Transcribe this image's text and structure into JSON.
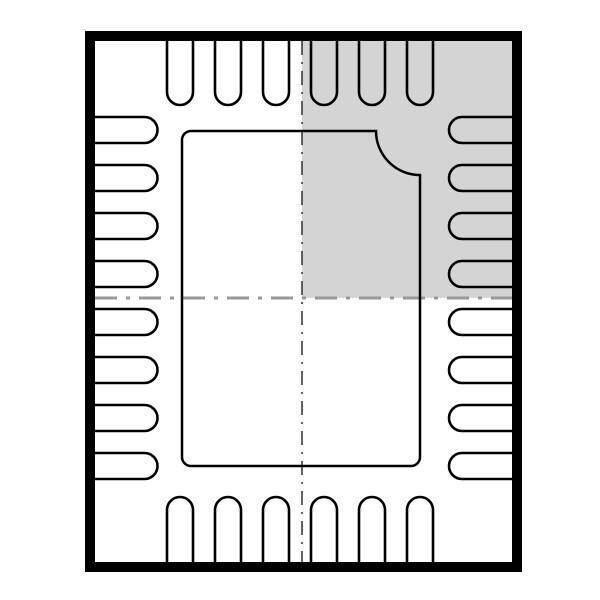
{
  "diagram": {
    "package_type": "QFN-28",
    "description": "ic-package-outline-top-view",
    "total_pins": 28,
    "colors": {
      "line": "#000000",
      "background": "#ffffff",
      "highlight_fill": "#d4d4d4",
      "centerline_horizontal": "#999999",
      "centerline_vertical": "#3d3d3d"
    },
    "outline": {
      "x": 90,
      "y": 36,
      "width": 427,
      "height": 531,
      "stroke_width": 10
    },
    "inner": {
      "left": 95,
      "top": 41,
      "right": 512,
      "bottom": 562
    },
    "center": {
      "x": 302,
      "y": 298
    },
    "highlight_quadrant": "top-right",
    "centerlines": {
      "horizontal_width": 3,
      "horizontal_dash": "22 9 4 9",
      "vertical_width": 1.6,
      "vertical_dash": "14 7 2 7"
    },
    "pins": {
      "per_side": {
        "top": 6,
        "bottom": 6,
        "left": 8,
        "right": 8
      },
      "half_width": 13,
      "stroke_width": 2.6,
      "top_bottom_centers_x": [
        180,
        228,
        276,
        324,
        372,
        420
      ],
      "left_right_centers_y": [
        130,
        178,
        226,
        274,
        322,
        370,
        418,
        466
      ],
      "top_cap_y": 92,
      "bottom_cap_y": 510,
      "left_cap_x": 144.5,
      "right_cap_x": 462
    },
    "pad": {
      "left": 182,
      "top": 131,
      "right": 420,
      "bottom": 466,
      "corner_radius": 9,
      "notch_corner": "top-right",
      "notch_radius": 44,
      "stroke_width": 2.5
    }
  }
}
